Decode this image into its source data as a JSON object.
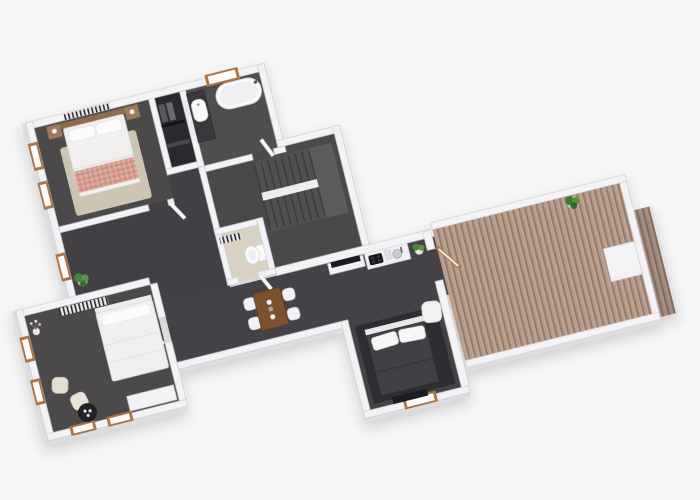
{
  "scene": {
    "type": "isometric-3d-floorplan-render",
    "background": "#f6f6f7",
    "palette": {
      "wall": "#f3f3f5",
      "wall_edge": "#c9c9cf",
      "wall_face": "#dcdce1",
      "floor": "#4b4949",
      "floor_hall": "#434144",
      "floor_closet": "#2b2b2d",
      "floor_wc": "#d9d2c3",
      "deck_wood": "#b59c8b",
      "deck_stripe": "#977c6a",
      "window_frame": "#ad7440",
      "rug_beige": "#cdc5b3",
      "blanket_pink": "#d69e92",
      "duvet_white": "#f1f0ef",
      "dark_rug": "#2f2f31",
      "mattress_dark": "#414144",
      "wood_table": "#7e512f",
      "plant_green": "#44823a",
      "stair_step": "#515153",
      "stair_line": "#3b3b3e",
      "toilet_white": "#fafafb",
      "tub_white": "#fbfbfc",
      "radiator_dark": "#2c2c2f"
    },
    "rooms": [
      "master-bedroom",
      "closet",
      "bathroom",
      "stair-hall",
      "wc",
      "hallway",
      "bedroom-2",
      "living-kitchen-corridor",
      "bedroom-3-lounge",
      "deck-terrace"
    ],
    "fixtures": [
      "double-bed-pink-throw",
      "bedside-tables",
      "wall-radiator",
      "wardrobe-rail",
      "vanity-sink",
      "mirror",
      "bathtub",
      "u-shaped-stairs",
      "toilet",
      "dining-table",
      "dining-chairs-x4",
      "tv-console",
      "kitchen-counter",
      "cooktop",
      "kitchen-sink",
      "potted-plant-kitchen",
      "glass-door-wood-frame",
      "white-double-bed",
      "armchairs-x2",
      "round-coffee-table",
      "sideboard",
      "flower-vase",
      "dark-double-bed",
      "white-pillows-x2",
      "foot-bench",
      "lounge-chair",
      "deck-planks",
      "deck-parapet",
      "potted-plant-deck",
      "potted-plant-hall",
      "windows-wood-frame",
      "open-door-leaves"
    ]
  }
}
